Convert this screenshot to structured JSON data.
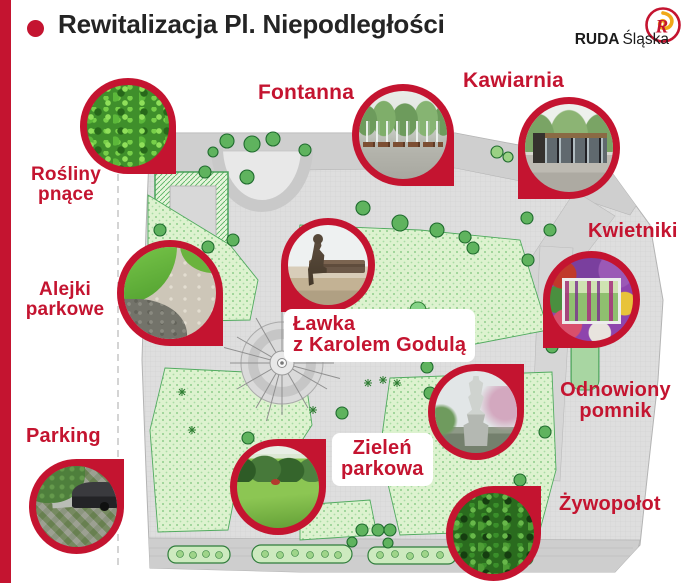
{
  "header": {
    "title": "Rewitalizacja Pl. Niepodległości"
  },
  "logo": {
    "name_bold": "RUDA",
    "name_light": "Śląska",
    "emblem_letter": "R"
  },
  "icons": {
    "title_bullet": "red-dot",
    "logo_emblem": "ruda-slaska-crest"
  },
  "callouts": {
    "rosliny_pnace": {
      "label": [
        "Rośliny",
        "pnące"
      ],
      "photo": "climbing-ivy"
    },
    "fontanna": {
      "label": [
        "Fontanna"
      ],
      "photo": "fountain"
    },
    "kawiarnia": {
      "label": [
        "Kawiarnia"
      ],
      "photo": "cafe-pavilion"
    },
    "kwietniki": {
      "label": [
        "Kwietniki"
      ],
      "photo": "flower-beds"
    },
    "alejki_parkowe": {
      "label": [
        "Alejki",
        "parkowe"
      ],
      "photo": "park-path"
    },
    "lawka_godula": {
      "label": [
        "Ławka",
        "z Karolem Godulą"
      ],
      "photo": "godula-bench-statue"
    },
    "odnowiony_pomnik": {
      "label": [
        "Odnowiony",
        "pomnik"
      ],
      "photo": "renovated-monument"
    },
    "parking": {
      "label": [
        "Parking"
      ],
      "photo": "green-parking"
    },
    "zielen_parkowa": {
      "label": [
        "Zieleń",
        "parkowa"
      ],
      "photo": "park-lawn"
    },
    "zywopolot": {
      "label": [
        "Żywopołot"
      ],
      "photo": "hedge"
    }
  },
  "colors": {
    "accent_red": "#c41430",
    "title_text": "#242424",
    "lawn_green": "#ddf2cf",
    "tree_green": "#5fb35e",
    "paving_gray": "#dedede"
  }
}
